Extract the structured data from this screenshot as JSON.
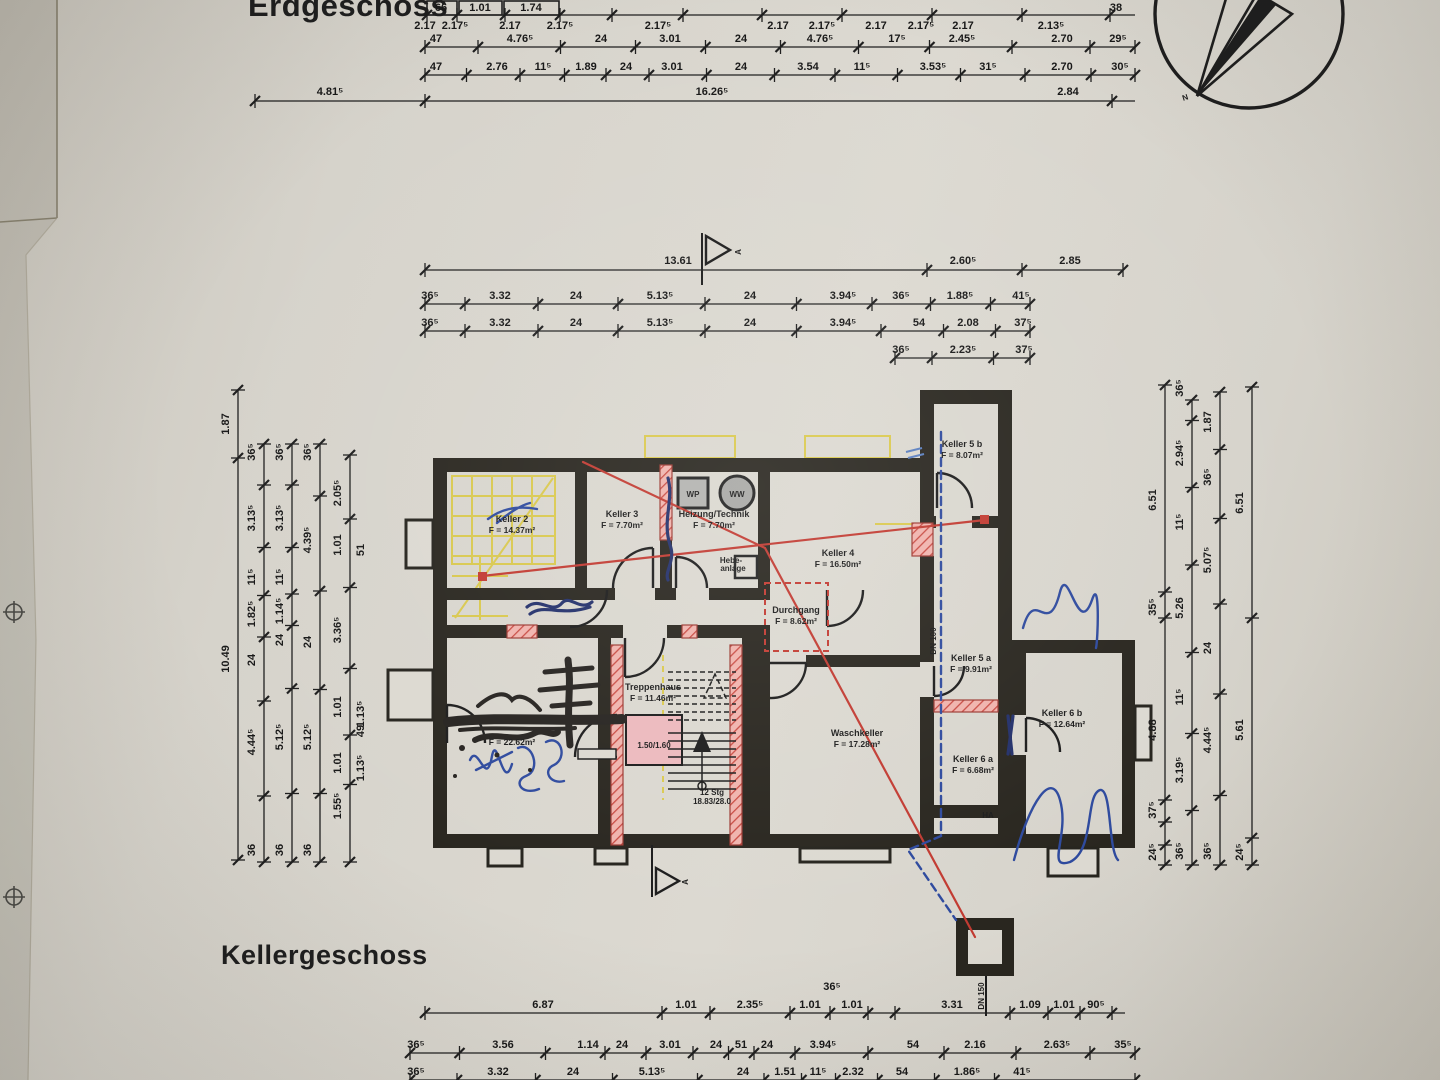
{
  "titles": {
    "top": "Erdgeschoss",
    "bottom": "Kellergeschoss"
  },
  "compass": {
    "north_label": "N"
  },
  "section_markers": {
    "top": "A",
    "bottom": "A"
  },
  "rooms": [
    {
      "name": "Keller 2",
      "area": "F = 14.37m²",
      "x": 512,
      "y": 522
    },
    {
      "name": "Keller 3",
      "area": "F = 7.70m²",
      "x": 622,
      "y": 517
    },
    {
      "name": "Heizung/Technik",
      "area": "F = 7.70m²",
      "x": 714,
      "y": 517
    },
    {
      "name": "Keller 4",
      "area": "F = 16.50m²",
      "x": 838,
      "y": 556
    },
    {
      "name": "Durchgang",
      "area": "F = 8.62m²",
      "x": 796,
      "y": 613
    },
    {
      "name": "Keller 5 b",
      "area": "F = 8.07m²",
      "x": 962,
      "y": 447
    },
    {
      "name": "Keller 5 a",
      "area": "F = 9.91m²",
      "x": 971,
      "y": 661
    },
    {
      "name": "Keller 6 a",
      "area": "F = 6.68m²",
      "x": 973,
      "y": 762
    },
    {
      "name": "Keller 6 b",
      "area": "F = 12.64m²",
      "x": 1062,
      "y": 716
    },
    {
      "name": "Treppenhaus",
      "area": "F = 11.46m²",
      "x": 653,
      "y": 690
    },
    {
      "name": "Waschkeller",
      "area": "F = 17.28m²",
      "x": 857,
      "y": 736
    },
    {
      "name": "",
      "area": "F = 22.62m²",
      "x": 512,
      "y": 734
    }
  ],
  "annotations": [
    {
      "t": "WP",
      "x": 693,
      "y": 497,
      "s": 8
    },
    {
      "t": "WW",
      "x": 737,
      "y": 497,
      "s": 8
    },
    {
      "t": "Hebe-",
      "x": 731,
      "y": 563,
      "s": 6.5,
      "a": "end"
    },
    {
      "t": "anlage",
      "x": 733,
      "y": 571,
      "s": 6.5,
      "a": "end"
    },
    {
      "t": "1.50/1.60",
      "x": 654,
      "y": 748,
      "s": 7.5
    },
    {
      "t": "12 Stg",
      "x": 712,
      "y": 795,
      "s": 7.5
    },
    {
      "t": "18.83/28.0",
      "x": 712,
      "y": 804,
      "s": 7.5
    },
    {
      "t": "DN 100",
      "x": 936,
      "y": 641,
      "s": 8,
      "rot": -90
    },
    {
      "t": "DN 150",
      "x": 984,
      "y": 996,
      "s": 8,
      "rot": -90
    },
    {
      "t": "HA",
      "x": 988,
      "y": 818,
      "s": 7.5
    },
    {
      "t": "A",
      "x": 741,
      "y": 252,
      "s": 13,
      "rot": -90
    },
    {
      "t": "A",
      "x": 688,
      "y": 882,
      "s": 13,
      "rot": -90
    },
    {
      "t": "N",
      "x": 1186,
      "y": 100,
      "s": 21,
      "rot": -18
    }
  ],
  "dims": {
    "h": [
      {
        "y": 15,
        "x1": 425,
        "x2": 1135,
        "ticks": [
          427,
          457,
          505,
          560,
          612,
          683,
          762,
          842,
          932,
          1022,
          1110
        ],
        "boxes": [
          [
            427,
            1,
            30,
            14
          ],
          [
            459,
            1,
            43,
            14
          ],
          [
            504,
            1,
            55,
            14
          ]
        ],
        "labels": [
          {
            "x": 441,
            "t": "66",
            "dy": -4
          },
          {
            "x": 480,
            "t": "1.01",
            "dy": -4
          },
          {
            "x": 531,
            "t": "1.74",
            "dy": -4
          },
          {
            "x": 1116,
            "t": "38",
            "dy": -4
          }
        ]
      },
      {
        "y": 29,
        "labels": [
          {
            "x": 425,
            "t": "2.17",
            "dy": 0
          },
          {
            "x": 455,
            "t": "2.17⁵",
            "dy": 0
          },
          {
            "x": 510,
            "t": "2.17",
            "dy": 0
          },
          {
            "x": 560,
            "t": "2.17⁵",
            "dy": 0
          },
          {
            "x": 658,
            "t": "2.17⁵",
            "dy": 0
          },
          {
            "x": 778,
            "t": "2.17",
            "dy": 0
          },
          {
            "x": 822,
            "t": "2.17⁵",
            "dy": 0
          },
          {
            "x": 876,
            "t": "2.17",
            "dy": 0
          },
          {
            "x": 921,
            "t": "2.17⁵",
            "dy": 0
          },
          {
            "x": 963,
            "t": "2.17",
            "dy": 0
          },
          {
            "x": 1051,
            "t": "2.13⁵",
            "dy": 0
          }
        ]
      },
      {
        "y": 47,
        "x1": 425,
        "x2": 1135,
        "labels": [
          {
            "x": 436,
            "t": "47"
          },
          {
            "x": 520,
            "t": "4.76⁵"
          },
          {
            "x": 601,
            "t": "24"
          },
          {
            "x": 670,
            "t": "3.01"
          },
          {
            "x": 741,
            "t": "24"
          },
          {
            "x": 820,
            "t": "4.76⁵"
          },
          {
            "x": 897,
            "t": "17⁵"
          },
          {
            "x": 962,
            "t": "2.45⁵"
          },
          {
            "x": 1062,
            "t": "2.70"
          },
          {
            "x": 1118,
            "t": "29⁵"
          }
        ]
      },
      {
        "y": 75,
        "x1": 425,
        "x2": 1135,
        "labels": [
          {
            "x": 436,
            "t": "47"
          },
          {
            "x": 497,
            "t": "2.76"
          },
          {
            "x": 543,
            "t": "11⁵"
          },
          {
            "x": 586,
            "t": "1.89"
          },
          {
            "x": 626,
            "t": "24"
          },
          {
            "x": 672,
            "t": "3.01"
          },
          {
            "x": 741,
            "t": "24"
          },
          {
            "x": 808,
            "t": "3.54"
          },
          {
            "x": 862,
            "t": "11⁵"
          },
          {
            "x": 933,
            "t": "3.53⁵"
          },
          {
            "x": 988,
            "t": "31⁵"
          },
          {
            "x": 1062,
            "t": "2.70"
          },
          {
            "x": 1120,
            "t": "30⁵"
          }
        ]
      },
      {
        "y": 101,
        "x1": 255,
        "x2": 1135,
        "ticks": [
          255,
          425,
          1112
        ],
        "labels": [
          {
            "x": 330,
            "t": "4.81⁵",
            "dy": -6
          },
          {
            "x": 712,
            "t": "16.26⁵",
            "dy": -6
          },
          {
            "x": 1068,
            "t": "2.84",
            "dy": -6
          }
        ]
      },
      {
        "y": 270,
        "x1": 425,
        "x2": 1123,
        "ticks": [
          425,
          927,
          1022,
          1123
        ],
        "labels": [
          {
            "x": 678,
            "t": "13.61",
            "dy": -6
          },
          {
            "x": 963,
            "t": "2.60⁵",
            "dy": -6
          },
          {
            "x": 1070,
            "t": "2.85",
            "dy": -6
          }
        ]
      },
      {
        "y": 304,
        "x1": 425,
        "x2": 1030,
        "labels": [
          {
            "x": 430,
            "t": "36⁵"
          },
          {
            "x": 500,
            "t": "3.32"
          },
          {
            "x": 576,
            "t": "24"
          },
          {
            "x": 660,
            "t": "5.13⁵"
          },
          {
            "x": 750,
            "t": "24"
          },
          {
            "x": 843,
            "t": "3.94⁵"
          },
          {
            "x": 901,
            "t": "36⁵"
          },
          {
            "x": 960,
            "t": "1.88⁵"
          },
          {
            "x": 1021,
            "t": "41⁵"
          }
        ]
      },
      {
        "y": 331,
        "x1": 425,
        "x2": 1030,
        "labels": [
          {
            "x": 430,
            "t": "36⁵"
          },
          {
            "x": 500,
            "t": "3.32"
          },
          {
            "x": 576,
            "t": "24"
          },
          {
            "x": 660,
            "t": "5.13⁵"
          },
          {
            "x": 750,
            "t": "24"
          },
          {
            "x": 843,
            "t": "3.94⁵"
          },
          {
            "x": 919,
            "t": "54"
          },
          {
            "x": 968,
            "t": "2.08"
          },
          {
            "x": 1023,
            "t": "37⁵"
          }
        ]
      },
      {
        "y": 358,
        "x1": 895,
        "x2": 1030,
        "labels": [
          {
            "x": 901,
            "t": "36⁵"
          },
          {
            "x": 963,
            "t": "2.23⁵"
          },
          {
            "x": 1024,
            "t": "37⁵"
          }
        ]
      },
      {
        "y": 1013,
        "x1": 425,
        "x2": 1125,
        "ticks": [
          425,
          662,
          710,
          790,
          830,
          868,
          895,
          1010,
          1048,
          1080,
          1112
        ],
        "labels": [
          {
            "x": 543,
            "t": "6.87"
          },
          {
            "x": 686,
            "t": "1.01"
          },
          {
            "x": 750,
            "t": "2.35⁵"
          },
          {
            "x": 810,
            "t": "1.01"
          },
          {
            "x": 852,
            "t": "1.01"
          },
          {
            "x": 952,
            "t": "3.31"
          },
          {
            "x": 1030,
            "t": "1.09"
          },
          {
            "x": 1064,
            "t": "1.01"
          },
          {
            "x": 1096,
            "t": "90⁵"
          }
        ]
      },
      {
        "y": 1053,
        "x1": 410,
        "x2": 1135,
        "labels": [
          {
            "x": 416,
            "t": "36⁵"
          },
          {
            "x": 503,
            "t": "3.56"
          },
          {
            "x": 588,
            "t": "1.14"
          },
          {
            "x": 622,
            "t": "24"
          },
          {
            "x": 670,
            "t": "3.01"
          },
          {
            "x": 716,
            "t": "24"
          },
          {
            "x": 741,
            "t": "51"
          },
          {
            "x": 767,
            "t": "24"
          },
          {
            "x": 823,
            "t": "3.94⁵"
          },
          {
            "x": 913,
            "t": "54"
          },
          {
            "x": 975,
            "t": "2.16"
          },
          {
            "x": 1057,
            "t": "2.63⁵"
          },
          {
            "x": 1123,
            "t": "35⁵"
          }
        ]
      },
      {
        "y": 1080,
        "x1": 410,
        "x2": 1135,
        "labels": [
          {
            "x": 416,
            "t": "36⁵"
          },
          {
            "x": 498,
            "t": "3.32"
          },
          {
            "x": 573,
            "t": "24"
          },
          {
            "x": 652,
            "t": "5.13⁵"
          },
          {
            "x": 743,
            "t": "24"
          },
          {
            "x": 785,
            "t": "1.51"
          },
          {
            "x": 818,
            "t": "11⁵"
          },
          {
            "x": 853,
            "t": "2.32"
          },
          {
            "x": 902,
            "t": "54"
          },
          {
            "x": 967,
            "t": "1.86⁵"
          },
          {
            "x": 1022,
            "t": "41⁵"
          }
        ]
      }
    ],
    "v": [
      {
        "x": 238,
        "y1": 390,
        "y2": 860,
        "ticks": [
          390,
          458,
          860
        ],
        "labels": [
          {
            "y": 424,
            "t": "1.87"
          },
          {
            "y": 659,
            "t": "10.49"
          }
        ]
      },
      {
        "x": 264,
        "y1": 444,
        "y2": 862,
        "labels": [
          {
            "y": 452,
            "t": "36⁵"
          },
          {
            "y": 518,
            "t": "3.13⁵"
          },
          {
            "y": 577,
            "t": "11⁵"
          },
          {
            "y": 614,
            "t": "1.82⁵"
          },
          {
            "y": 660,
            "t": "24"
          },
          {
            "y": 742,
            "t": "4.44⁵"
          },
          {
            "y": 850,
            "t": "36"
          }
        ]
      },
      {
        "x": 292,
        "y1": 444,
        "y2": 862,
        "labels": [
          {
            "y": 452,
            "t": "36⁵"
          },
          {
            "y": 518,
            "t": "3.13⁵"
          },
          {
            "y": 577,
            "t": "11⁵"
          },
          {
            "y": 611,
            "t": "1.14⁵"
          },
          {
            "y": 640,
            "t": "24"
          },
          {
            "y": 737,
            "t": "5.12⁵"
          },
          {
            "y": 850,
            "t": "36"
          }
        ]
      },
      {
        "x": 320,
        "y1": 444,
        "y2": 862,
        "labels": [
          {
            "y": 452,
            "t": "36⁵"
          },
          {
            "y": 540,
            "t": "4.39⁵"
          },
          {
            "y": 642,
            "t": "24"
          },
          {
            "y": 737,
            "t": "5.12⁵"
          },
          {
            "y": 850,
            "t": "36"
          }
        ]
      },
      {
        "x": 350,
        "y1": 455,
        "y2": 862,
        "labels": [
          {
            "y": 493,
            "t": "2.05⁵"
          },
          {
            "y": 545,
            "t": "1.01"
          },
          {
            "y": 630,
            "t": "3.36⁵"
          },
          {
            "y": 707,
            "t": "1.01"
          },
          {
            "y": 763,
            "t": "1.01"
          },
          {
            "y": 806,
            "t": "1.55⁵"
          },
          {
            "y": 550,
            "t": "51",
            "side": "r"
          },
          {
            "y": 714,
            "t": "1.13⁵",
            "side": "r"
          },
          {
            "y": 731,
            "t": "49",
            "side": "r"
          },
          {
            "y": 768,
            "t": "1.13⁵",
            "side": "r"
          }
        ]
      },
      {
        "x": 1165,
        "y1": 385,
        "y2": 865,
        "ticks": [
          385,
          592,
          618,
          800,
          822,
          845,
          865
        ],
        "labels": [
          {
            "y": 500,
            "t": "6.51"
          },
          {
            "y": 607,
            "t": "35⁵"
          },
          {
            "y": 730,
            "t": "4.88"
          },
          {
            "y": 810,
            "t": "37⁵"
          },
          {
            "y": 852,
            "t": "24⁵"
          }
        ]
      },
      {
        "x": 1192,
        "y1": 400,
        "y2": 865,
        "labels": [
          {
            "y": 388,
            "t": "36⁵"
          },
          {
            "y": 453,
            "t": "2.94⁵"
          },
          {
            "y": 522,
            "t": "11⁵"
          },
          {
            "y": 608,
            "t": "5.26"
          },
          {
            "y": 697,
            "t": "11⁵"
          },
          {
            "y": 770,
            "t": "3.19⁵"
          },
          {
            "y": 851,
            "t": "36⁵"
          }
        ]
      },
      {
        "x": 1220,
        "y1": 392,
        "y2": 865,
        "labels": [
          {
            "y": 422,
            "t": "1.87"
          },
          {
            "y": 477,
            "t": "36⁵"
          },
          {
            "y": 560,
            "t": "5.07⁵"
          },
          {
            "y": 648,
            "t": "24"
          },
          {
            "y": 740,
            "t": "4.44⁵"
          },
          {
            "y": 851,
            "t": "36⁵"
          }
        ]
      },
      {
        "x": 1252,
        "y1": 387,
        "y2": 865,
        "ticks": [
          387,
          618,
          838,
          865
        ],
        "labels": [
          {
            "y": 503,
            "t": "6.51"
          },
          {
            "y": 730,
            "t": "5.61"
          },
          {
            "y": 852,
            "t": "24⁵"
          }
        ]
      }
    ],
    "free": [
      {
        "x": 832,
        "y": 990,
        "t": "36⁵"
      }
    ]
  }
}
